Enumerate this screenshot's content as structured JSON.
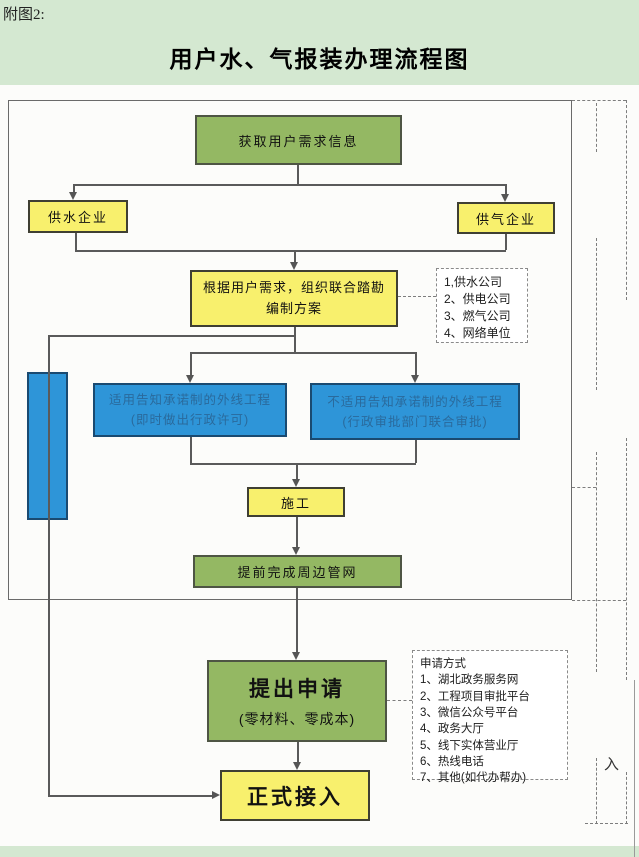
{
  "header": {
    "tag": "附图2:",
    "title": "用户水、气报装办理流程图"
  },
  "flow": {
    "get_demand": "获取用户需求信息",
    "water_company": "供水企业",
    "gas_company": "供气企业",
    "plan_line1": "根据用户需求，组织联合踏勘",
    "plan_line2": "编制方案",
    "promise_line1": "适用告知承诺制的外线工程",
    "promise_line2": "(即时做出行政许可)",
    "no_promise_line1": "不适用告知承诺制的外线工程",
    "no_promise_line2": "(行政审批部门联合审批)",
    "construction": "施工",
    "pipe_network": "提前完成周边管网",
    "submit_line1": "提出申请",
    "submit_line2": "(零材料、零成本)",
    "connect": "正式接入"
  },
  "notes": {
    "survey_units": [
      "1,供水公司",
      "2、供电公司",
      "3、燃气公司",
      "4、网络单位"
    ],
    "apply_title": "申请方式",
    "apply_methods": [
      "1、湖北政务服务网",
      "2、工程项目审批平台",
      "3、微信公众号平台",
      "4、政务大厅",
      "5、线下实体营业厅",
      "6、热线电话",
      "7、其他(如代办帮办)"
    ],
    "enter_label": "入"
  },
  "colors": {
    "header_bg": "#d4e8d1",
    "green_box": "#94b863",
    "yellow_box": "#f8f06d",
    "blue_box": "#2e95d8",
    "line": "#5a5a5a"
  }
}
